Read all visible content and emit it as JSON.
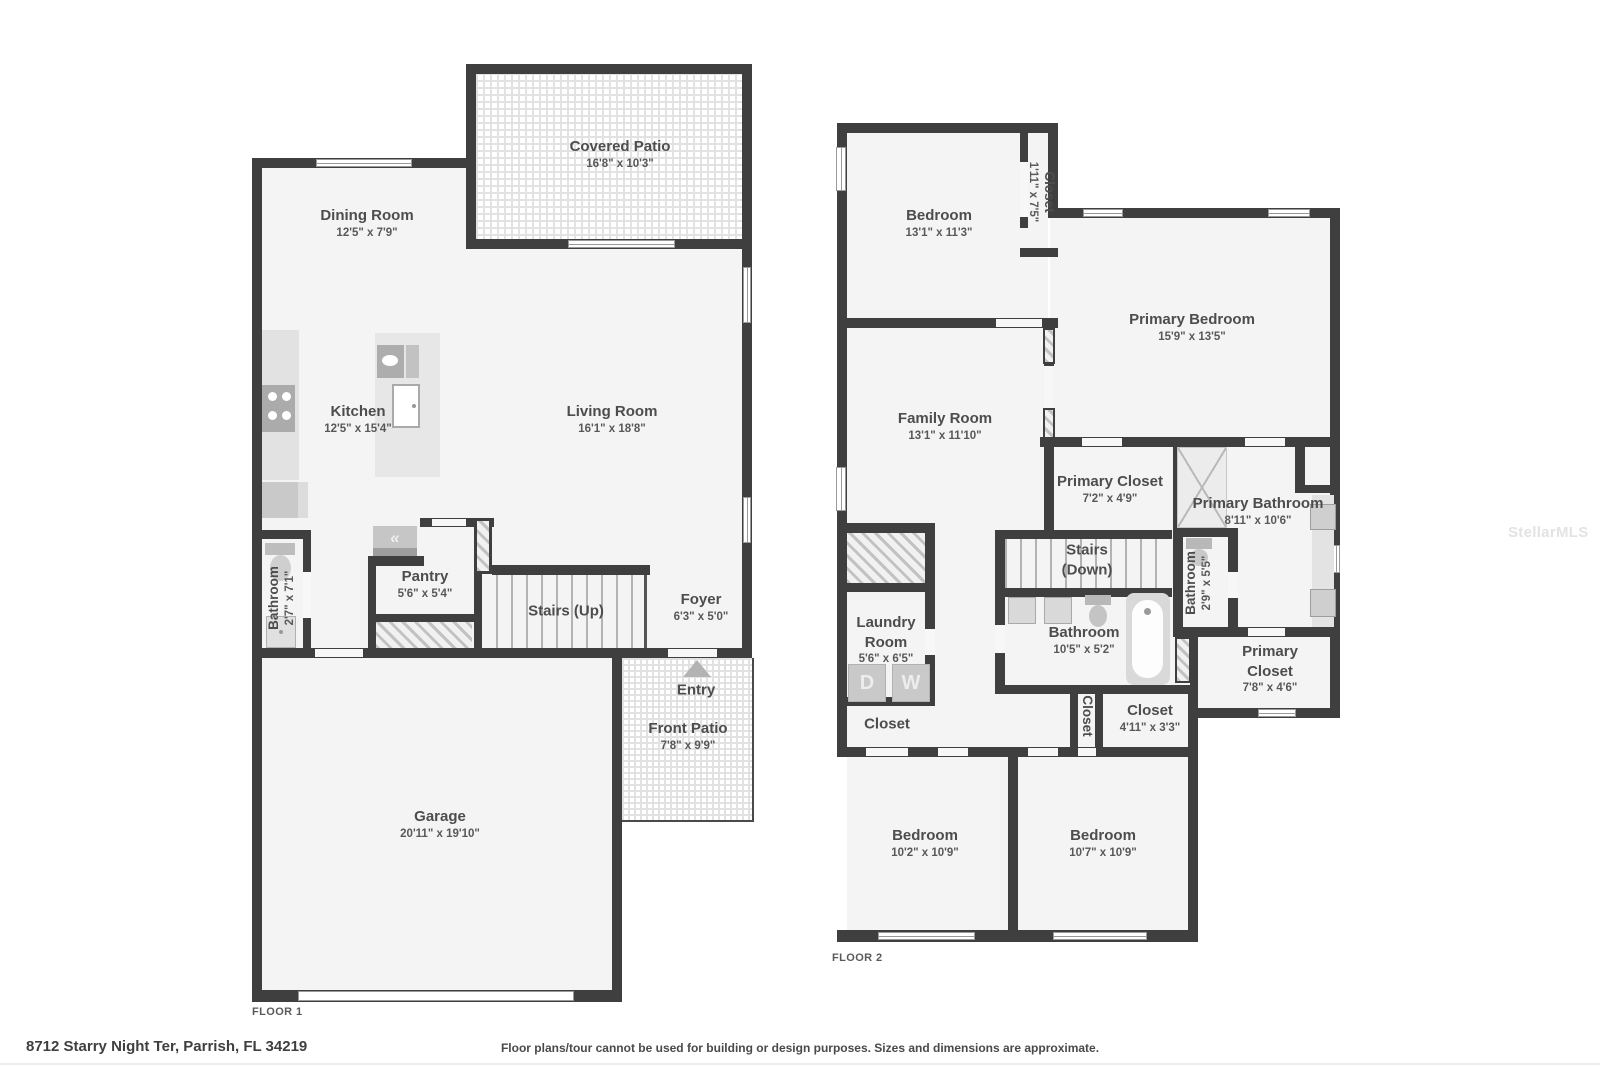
{
  "page": {
    "address": "8712 Starry Night Ter, Parrish, FL 34219",
    "disclaimer": "Floor plans/tour cannot be used for building or design purposes. Sizes and dimensions are approximate.",
    "watermark": "StellarMLS",
    "floor1_label": "FLOOR 1",
    "floor2_label": "FLOOR 2"
  },
  "floor1": {
    "rooms": {
      "covered_patio": {
        "name": "Covered Patio",
        "dims": "16'8\" x 10'3\""
      },
      "dining_room": {
        "name": "Dining Room",
        "dims": "12'5\" x 7'9\""
      },
      "kitchen": {
        "name": "Kitchen",
        "dims": "12'5\" x 15'4\""
      },
      "living_room": {
        "name": "Living Room",
        "dims": "16'1\" x 18'8\""
      },
      "bathroom": {
        "name": "Bathroom",
        "dims": "2'7\" x 7'1\""
      },
      "pantry": {
        "name": "Pantry",
        "dims": "5'6\" x 5'4\""
      },
      "stairs": {
        "name": "Stairs (Up)"
      },
      "foyer": {
        "name": "Foyer",
        "dims": "6'3\" x 5'0\""
      },
      "entry": {
        "name": "Entry"
      },
      "front_patio": {
        "name": "Front Patio",
        "dims": "7'8\" x 9'9\""
      },
      "garage": {
        "name": "Garage",
        "dims": "20'11\" x 19'10\""
      }
    }
  },
  "floor2": {
    "rooms": {
      "bedroom1": {
        "name": "Bedroom",
        "dims": "13'1\" x 11'3\""
      },
      "closet1": {
        "name": "Closet",
        "dims": "1'11\" x 7'5\""
      },
      "primary_bedroom": {
        "name": "Primary Bedroom",
        "dims": "15'9\" x 13'5\""
      },
      "family_room": {
        "name": "Family Room",
        "dims": "13'1\" x 11'10\""
      },
      "primary_closet1": {
        "name": "Primary Closet",
        "dims": "7'2\" x 4'9\""
      },
      "primary_bathroom": {
        "name": "Primary Bathroom",
        "dims": "8'11\" x 10'6\""
      },
      "stairs": {
        "name": "Stairs (Down)"
      },
      "bathroom_small": {
        "name": "Bathroom",
        "dims": "2'9\" x 5'5\""
      },
      "laundry_room": {
        "name": "Laundry Room",
        "dims": "5'6\" x 6'5\""
      },
      "bathroom": {
        "name": "Bathroom",
        "dims": "10'5\" x 5'2\""
      },
      "closet_laundry": {
        "name": "Closet"
      },
      "closet_hall": {
        "name": "Closet"
      },
      "closet2": {
        "name": "Closet",
        "dims": "4'11\" x 3'3\""
      },
      "primary_closet2": {
        "name": "Primary Closet",
        "dims": "7'8\" x 4'6\""
      },
      "bedroom2": {
        "name": "Bedroom",
        "dims": "10'2\" x 10'9\""
      },
      "bedroom3": {
        "name": "Bedroom",
        "dims": "10'7\" x 10'9\""
      }
    }
  },
  "appliances": {
    "dryer": "D",
    "washer": "W"
  },
  "icons": {
    "pantry_vent": "«"
  }
}
